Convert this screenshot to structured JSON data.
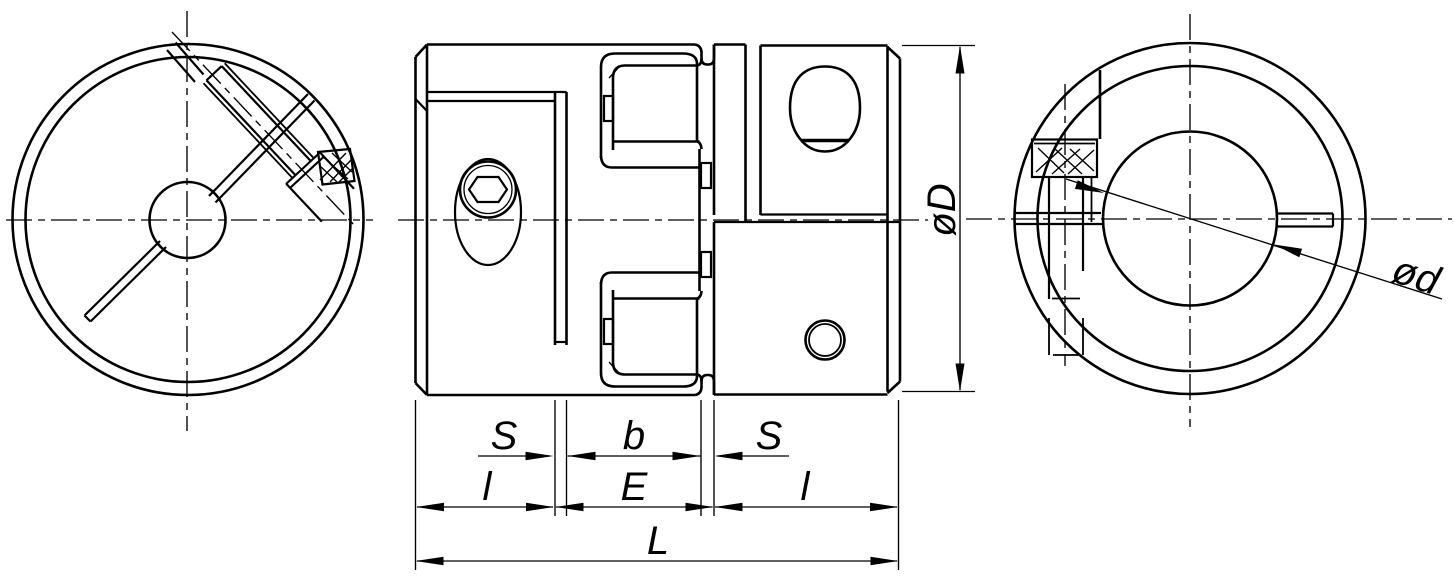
{
  "drawing": {
    "line_color": "#000000",
    "background_color": "#ffffff",
    "dimensions": {
      "gap_left": "S",
      "spider_width": "b",
      "gap_right": "S",
      "hub_length_left": "l",
      "center_distance": "E",
      "hub_length_right": "l",
      "overall_length": "L",
      "outer_diameter": "øD",
      "bore_diameter": "ød"
    }
  }
}
